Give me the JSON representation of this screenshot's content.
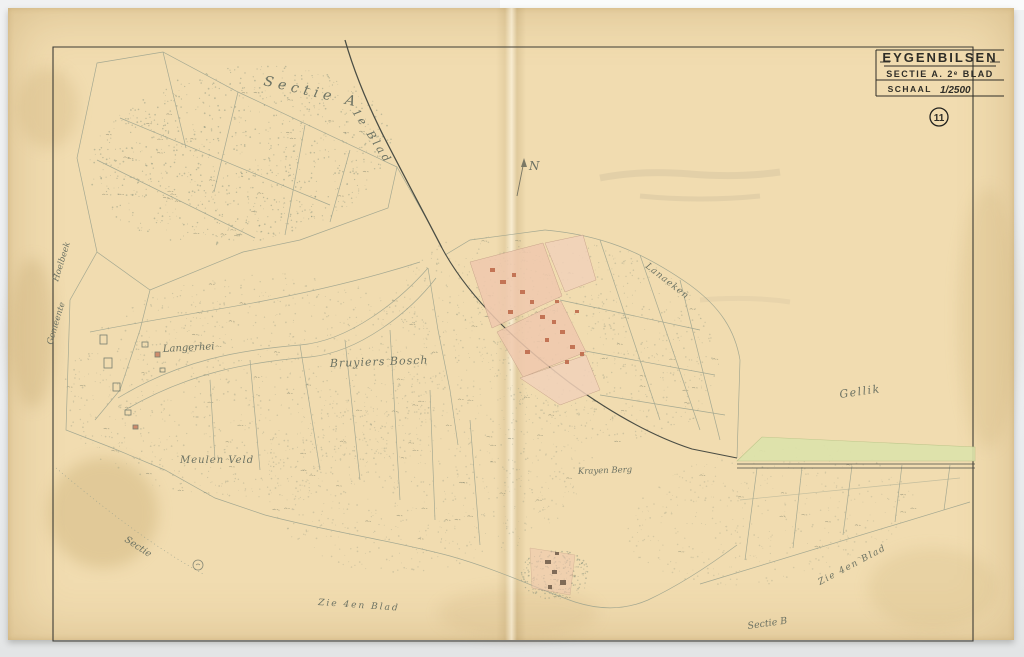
{
  "title_block": {
    "title": "EYGENBILSEN",
    "section_line": "SECTIE A. 2ᵉ BLAD",
    "scale_label": "SCHAAL",
    "scale_value": "1/2500",
    "sheet_number": "11"
  },
  "map_labels": {
    "section": "Sectie A",
    "sheet_boundary": "1e Blad",
    "north": "N",
    "gemeente": "Gemeente",
    "hoelbeek": "Hoelbeek",
    "langerhei": "Langerhei",
    "bruyiers_bosch": "Bruyiers Bosch",
    "meulen_veld": "Meulen Veld",
    "krayen_berg": "Krayen Berg",
    "gellik": "Gellik",
    "lanaeken": "Lanaeken",
    "sectie_corner": "Sectie",
    "zie_blad_bottom": "Zie 4en Blad",
    "zie_blad_right": "Zie 4en Blad",
    "sectie_b": "Sectie B"
  },
  "colors": {
    "paper": "#f1dcb0",
    "ink": "#35342e",
    "pencil": "#8e9682",
    "village_pink": "#f0c9ae",
    "building_red": "#bf6b4c",
    "meadow_green": "#dde3ab"
  }
}
